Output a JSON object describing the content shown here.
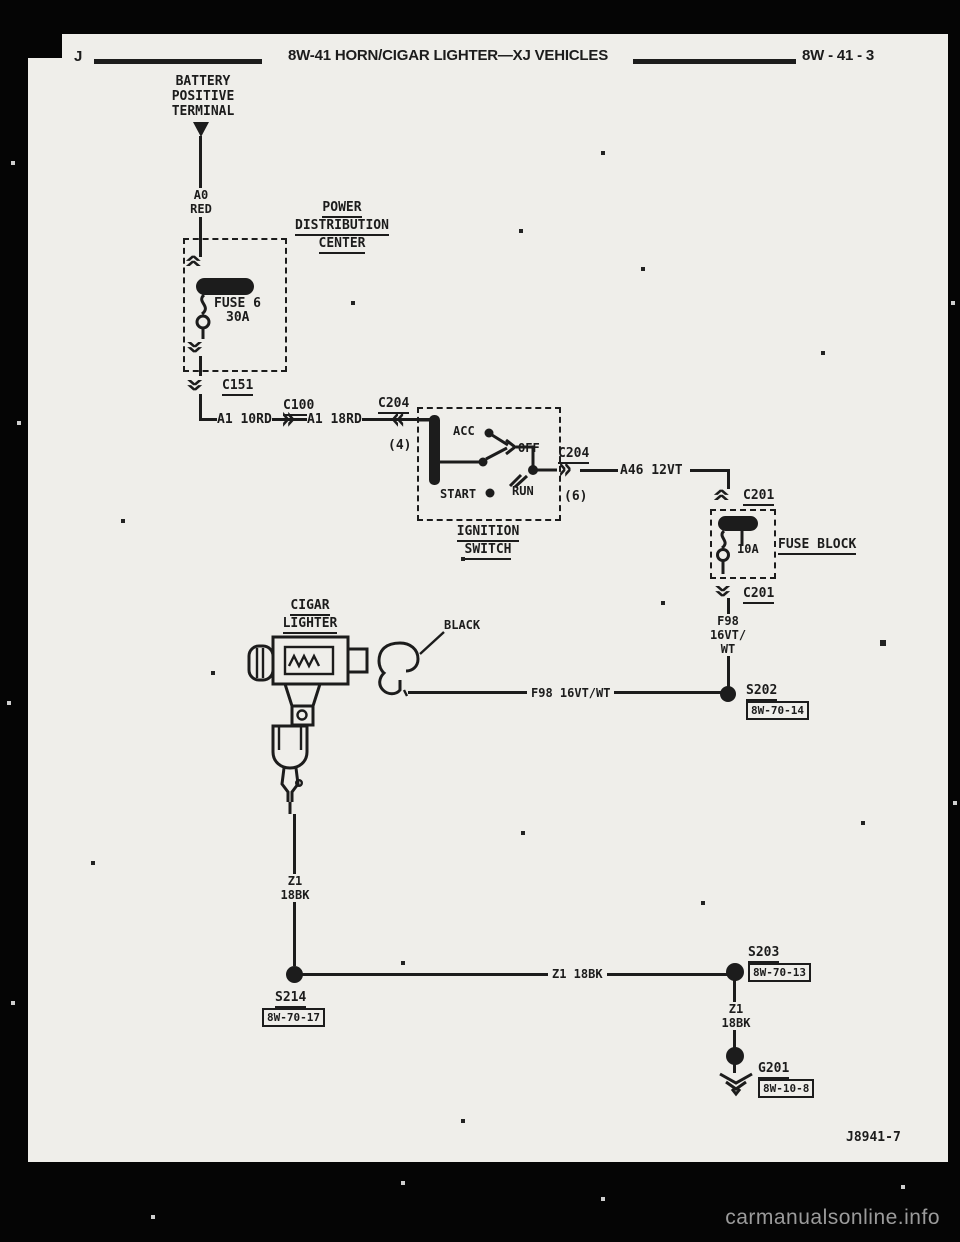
{
  "header": {
    "letter": "J",
    "title": "8W-41 HORN/CIGAR LIGHTER—XJ VEHICLES",
    "page_ref": "8W - 41 - 3"
  },
  "icons": {
    "chev_right": "»",
    "chev_left": "«"
  },
  "battery": {
    "l1": "BATTERY",
    "l2": "POSITIVE",
    "l3": "TERMINAL"
  },
  "pdc": {
    "l1": "POWER",
    "l2": "DISTRIBUTION",
    "l3": "CENTER",
    "fuse": "FUSE 6",
    "rating": "30A"
  },
  "fuse_block": {
    "label": "FUSE BLOCK",
    "rating": "10A"
  },
  "ignition": {
    "l1": "IGNITION",
    "l2": "SWITCH",
    "acc": "ACC",
    "off": "OFF",
    "run": "RUN",
    "start": "START"
  },
  "lighter": {
    "l1": "CIGAR",
    "l2": "LIGHTER",
    "connector": "BLACK"
  },
  "wires": {
    "a0_1": "A0",
    "a0_2": "RED",
    "a1_a": "A1 10RD",
    "a1_b": "A1 18RD",
    "a46": "A46 12VT",
    "f98_1": "F98",
    "f98_2": "16VT/",
    "f98_3": "WT",
    "f98_h": "F98 16VT/WT",
    "z1_1": "Z1",
    "z1_2": "18BK",
    "z1_h": "Z1 18BK",
    "z1_3": "Z1",
    "z1_4": "18BK"
  },
  "connectors": {
    "c151": "C151",
    "c100": "C100",
    "c204_in": "C204",
    "c204_in_pin": "(4)",
    "c204_out": "C204",
    "c204_out_pin": "(6)",
    "c201_in": "C201",
    "c201_out": "C201"
  },
  "splices": {
    "s202": "S202",
    "s202_ref": "8W-70-14",
    "s214": "S214",
    "s214_ref": "8W-70-17",
    "s203": "S203",
    "s203_ref": "8W-70-13"
  },
  "ground": {
    "name": "G201",
    "ref": "8W-10-8"
  },
  "footer": {
    "figure_code": "J8941-7",
    "watermark": "carmanualsonline.info"
  }
}
